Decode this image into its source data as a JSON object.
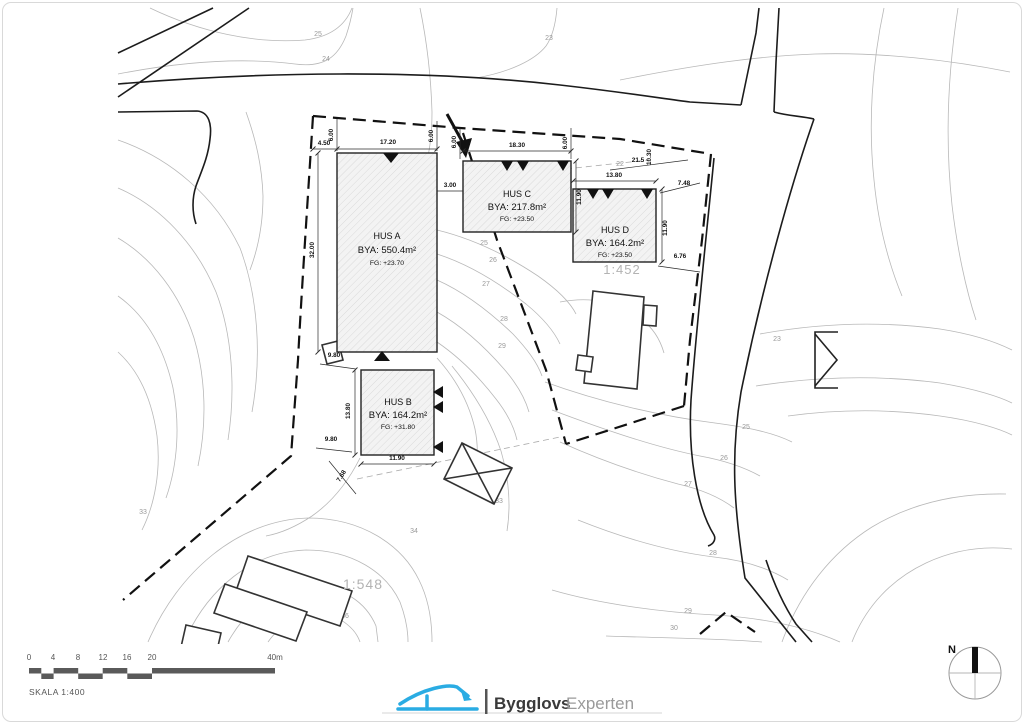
{
  "title_block": {
    "scale_label": "SKALA 1:400",
    "north_label": "N"
  },
  "logo": {
    "bold": "Bygglovs",
    "light": "Experten"
  },
  "scalebar": {
    "t0": "0",
    "t4": "4",
    "t8": "8",
    "t12": "12",
    "t16": "16",
    "t20": "20",
    "t40": "40m"
  },
  "parcels": {
    "right": "1:452",
    "left": "1:548"
  },
  "buildings": {
    "a": {
      "name": "HUS A",
      "bya": "BYA: 550.4m²",
      "fg": "FG: +23.70"
    },
    "b": {
      "name": "HUS B",
      "bya": "BYA: 164.2m²",
      "fg": "FG: +31.80"
    },
    "c": {
      "name": "HUS C",
      "bya": "BYA: 217.8m²",
      "fg": "FG: +23.50"
    },
    "d": {
      "name": "HUS D",
      "bya": "BYA: 164.2m²",
      "fg": "FG: +23.50"
    }
  },
  "dims": {
    "a_450": "4.50",
    "a_600_left": "6.00",
    "a_1720": "17.20",
    "a_600_right": "6.00",
    "c_600_left": "6.00",
    "c_1830": "18.30",
    "c_600_right": "6.00",
    "c_300": "3.00",
    "c_1190": "11.90",
    "d_215": "21.5",
    "d_1030": "10.30",
    "d_1380": "13.80",
    "d_748": "7.48",
    "d_1190": "11.90",
    "d_676": "6.76",
    "a_3200": "32.00",
    "a_980": "9.80",
    "b_1380": "13.80",
    "b_980": "9.80",
    "b_1190": "11.90",
    "b_768": "7.68"
  },
  "contours": {
    "c25_top": "25",
    "c24_top": "24",
    "c23_top": "23",
    "c22": "22",
    "c25_mid": "25",
    "c26_mid": "26",
    "c27_mid": "27",
    "c28_mid": "28",
    "c29_mid": "29",
    "c25_right": "25",
    "c26_right": "26",
    "c27_right": "27",
    "c28_right": "28",
    "c29_right": "29",
    "c30_right": "30",
    "c33_left": "33",
    "c34_left": "34",
    "c36_left": "36",
    "c33_mid": "33",
    "c23_right": "23"
  },
  "colors": {
    "logo_blue": "#2aace3",
    "line_dark": "#1c1c1c",
    "contour_gray": "#b8b8b8"
  }
}
